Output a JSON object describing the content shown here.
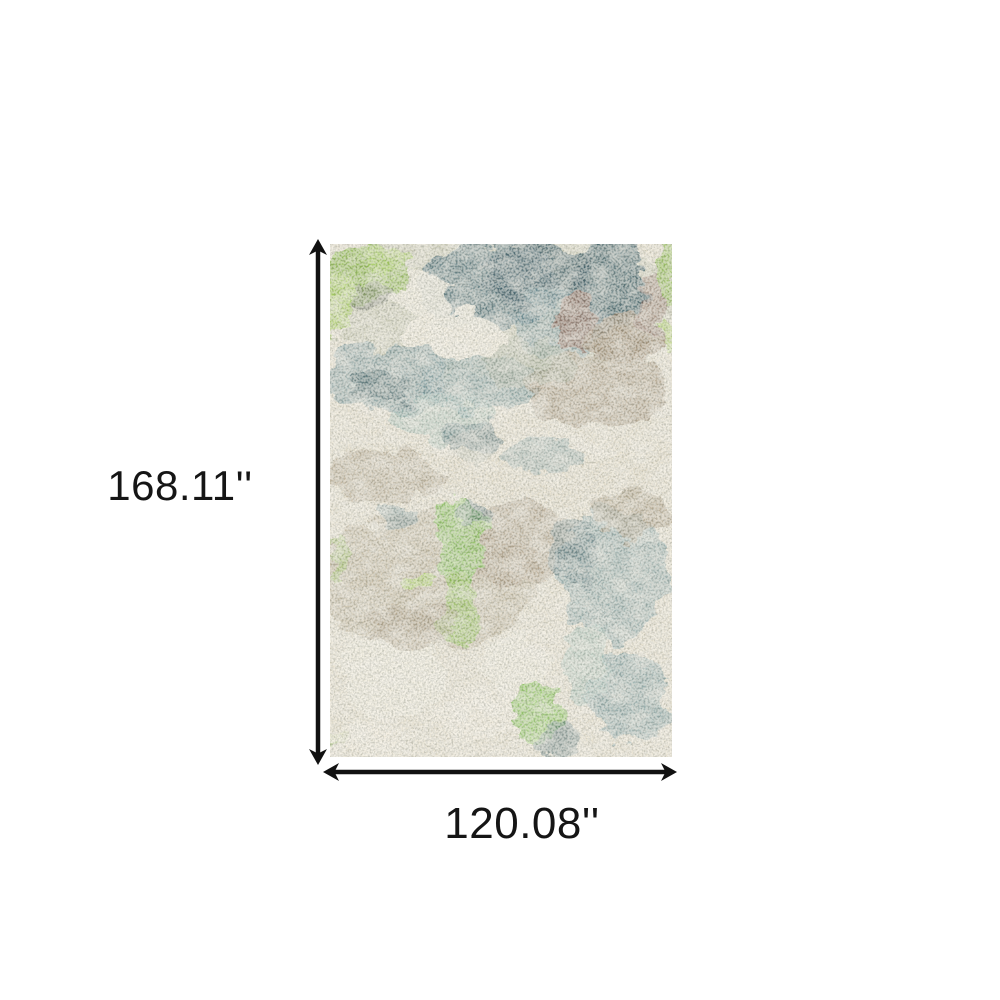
{
  "page": {
    "background": "#ffffff"
  },
  "diagram": {
    "type": "product-dimension-diagram",
    "height_label": "168.11''",
    "width_label": "120.08''",
    "arrow_color": "#111111",
    "label_color": "#151515"
  },
  "rug": {
    "description": "abstract distressed area rug in green, teal, blue grey, taupe and ivory",
    "palette": {
      "base": "#e7e1d0",
      "ivory": "#f0ebdc",
      "beige": "#e3dcc8",
      "sage": "#b9bfa6",
      "olive": "#9aa590",
      "grey": "#6a6f62",
      "teal_dark": "#3f5f68",
      "teal": "#55747c",
      "teal_soft": "#6d9097",
      "blue_grey": "#7fa0a4",
      "blue_grey_light": "#9dbcb6",
      "taupe": "#a3937a",
      "taupe_light": "#b3a78f",
      "brown": "#927d63",
      "mauve": "#87685c",
      "lime": "#8dbb4d",
      "lime_bright": "#7fbf4d",
      "lime_soft": "#a5ce5a"
    }
  }
}
